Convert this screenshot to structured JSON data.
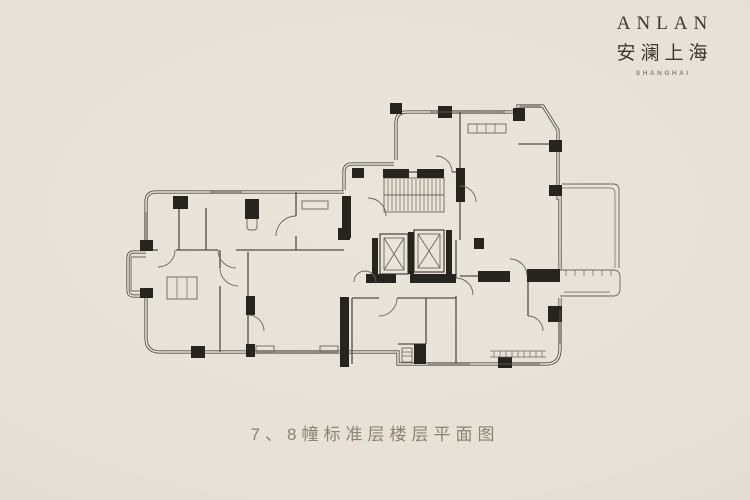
{
  "brand": {
    "logo_en": "ANLAN",
    "logo_cn": "安澜上海",
    "logo_sub": "SHANGHAI"
  },
  "caption": "7、8幢标准层楼层平面图",
  "colors": {
    "background": "#e6e1d7",
    "paper_light": "#eae5db",
    "vignette": "#d9d4c9",
    "line": "#45423b",
    "line_light": "#5f5b52",
    "column": "#16140f",
    "caption_text": "#8e8270",
    "logo_text": "#3b3833",
    "logo_sub": "#8a8173"
  },
  "floorplan": {
    "features": [
      "exterior-walls",
      "interior-walls",
      "structural-columns",
      "staircase",
      "elevator-1",
      "elevator-2",
      "terrace",
      "right-balcony",
      "bay-window",
      "door-swings",
      "windows"
    ]
  }
}
